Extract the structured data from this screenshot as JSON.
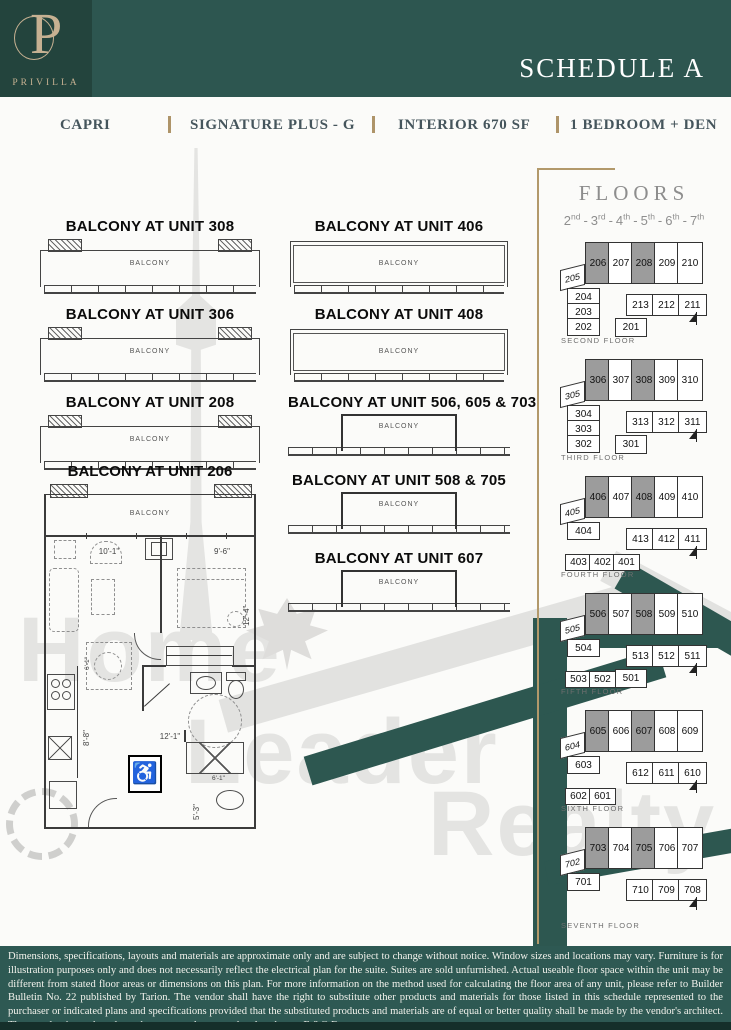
{
  "header": {
    "monogram": "P",
    "brand": "PRIVILLA",
    "schedule_title": "SCHEDULE A"
  },
  "subtitle": {
    "project": "CAPRI",
    "model": "SIGNATURE PLUS - G",
    "interior": "INTERIOR 670 SF",
    "bedrooms": "1 BEDROOM + DEN"
  },
  "floors_panel": {
    "title": "FLOORS",
    "floors": [
      {
        "num": "2",
        "suffix": "nd"
      },
      {
        "num": "3",
        "suffix": "rd"
      },
      {
        "num": "4",
        "suffix": "th"
      },
      {
        "num": "5",
        "suffix": "th"
      },
      {
        "num": "6",
        "suffix": "th"
      },
      {
        "num": "7",
        "suffix": "th"
      }
    ]
  },
  "key_plans": [
    {
      "label": "SECOND FLOOR",
      "top": [
        "206",
        "207",
        "208",
        "209",
        "210"
      ],
      "shaded": [
        "206",
        "208"
      ],
      "left": "205",
      "col": [
        "204",
        "203",
        "202"
      ],
      "bottom": [],
      "center": "201",
      "mid": [
        "213",
        "212",
        "211"
      ]
    },
    {
      "label": "THIRD FLOOR",
      "top": [
        "306",
        "307",
        "308",
        "309",
        "310"
      ],
      "shaded": [
        "306",
        "308"
      ],
      "left": "305",
      "col": [
        "304",
        "303",
        "302"
      ],
      "bottom": [],
      "center": "301",
      "mid": [
        "313",
        "312",
        "311"
      ]
    },
    {
      "label": "FOURTH FLOOR",
      "top": [
        "406",
        "407",
        "408",
        "409",
        "410"
      ],
      "shaded": [
        "406",
        "408"
      ],
      "left": "405",
      "col": [
        "404"
      ],
      "bottom": [
        "403",
        "402",
        "401"
      ],
      "center": "",
      "mid": [
        "413",
        "412",
        "411"
      ]
    },
    {
      "label": "FIFTH FLOOR",
      "top": [
        "506",
        "507",
        "508",
        "509",
        "510"
      ],
      "shaded": [
        "506",
        "508"
      ],
      "left": "505",
      "col": [
        "504"
      ],
      "bottom": [
        "503",
        "502"
      ],
      "center": "501",
      "mid": [
        "513",
        "512",
        "511"
      ]
    },
    {
      "label": "SIXTH FLOOR",
      "top": [
        "605",
        "606",
        "607",
        "608",
        "609"
      ],
      "shaded": [
        "605",
        "607"
      ],
      "left": "604",
      "col": [
        "603"
      ],
      "bottom": [
        "602",
        "601"
      ],
      "center": "",
      "mid": [
        "612",
        "611",
        "610"
      ]
    },
    {
      "label": "SEVENTH FLOOR",
      "top": [
        "703",
        "704",
        "705",
        "706",
        "707"
      ],
      "shaded": [
        "703",
        "705"
      ],
      "left": "702",
      "col": [
        "701"
      ],
      "bottom": [],
      "center": "",
      "mid": [
        "710",
        "709",
        "708"
      ]
    }
  ],
  "balconies": {
    "room_label": "BALCONY",
    "left_column": [
      {
        "title": "BALCONY AT UNIT 308",
        "variant": "wide"
      },
      {
        "title": "BALCONY AT UNIT 306",
        "variant": "wide"
      },
      {
        "title": "BALCONY AT UNIT 208",
        "variant": "wide"
      }
    ],
    "middle_column": [
      {
        "title": "BALCONY AT UNIT 406",
        "variant": "wide2"
      },
      {
        "title": "BALCONY AT UNIT 408",
        "variant": "wide2"
      },
      {
        "title": "BALCONY AT UNIT 506, 605 & 703",
        "variant": "center"
      },
      {
        "title": "BALCONY AT UNIT 508 & 705",
        "variant": "center"
      },
      {
        "title": "BALCONY AT UNIT 607",
        "variant": "center"
      }
    ]
  },
  "main_plan": {
    "title": "BALCONY AT UNIT 206",
    "balcony_label": "BALCONY",
    "dims": {
      "living_width": "10'-1\"",
      "bed_width": "9'-6\"",
      "bed_depth": "12'-4\"",
      "hall_width": "12'-1\"",
      "kitchen_depth": "8'-8\"",
      "bath_depth": "5'-3\"",
      "dining": "6'-1\"",
      "shower": "6'-1\""
    }
  },
  "watermark": {
    "line1": "Home",
    "line2": "Leader",
    "line3": "Realty"
  },
  "disclaimer": "Dimensions, specifications, layouts and materials are approximate only and are subject to change without notice. Window sizes and locations may vary. Furniture is for illustration purposes only and does not necessarily reflect the electrical plan for the suite. Suites are sold unfurnished. Actual useable floor space within the unit may be different from stated floor areas or dimensions on this plan. For more information on the method used for calculating the floor area of any unit, please refer to Builder Bulletin No. 22 published by Tarion. The vendor shall have the right to substitute other products and materials for those listed in this schedule represented to the purchaser or indicated plans and specifications provided that the substituted products and materials are of equal or better quality shall be made by the vendor's architect. The actual unit purchased may be a reverse layout to the plan shown. E.&O.E.",
  "colors": {
    "teal": "#2d5650",
    "teal_dark": "#23443d",
    "tan": "#c6b192",
    "gold": "#ae9469",
    "unit_shade": "#9c9c9c"
  }
}
